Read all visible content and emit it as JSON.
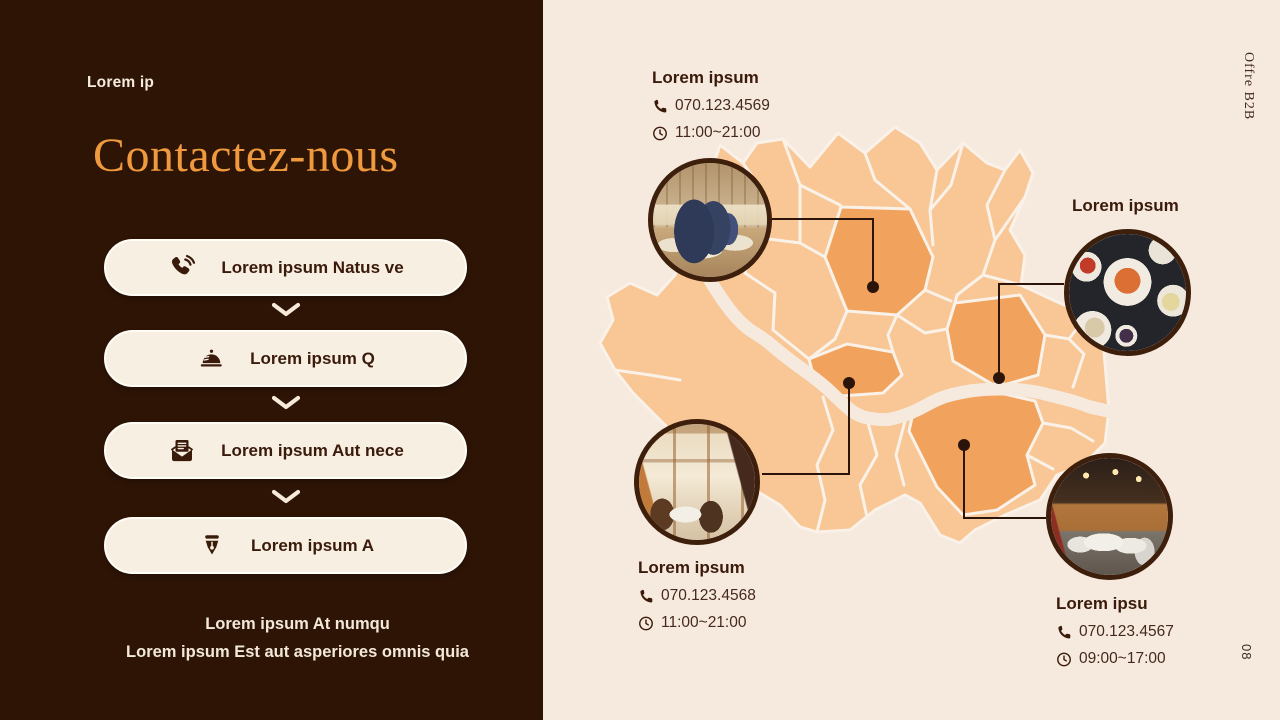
{
  "slide": {
    "eyebrow": "Lorem ip",
    "title": "Contactez-nous",
    "menu": [
      {
        "icon": "phone-ring-icon",
        "label": "Lorem ipsum Natus ve"
      },
      {
        "icon": "cloche-icon",
        "label": "Lorem ipsum Q"
      },
      {
        "icon": "mail-icon",
        "label": "Lorem ipsum Aut nece"
      },
      {
        "icon": "pen-nib-icon",
        "label": "Lorem ipsum A"
      }
    ],
    "footer_line1": "Lorem ipsum At numqu",
    "footer_line2": "Lorem ipsum Est aut asperiores omnis quia",
    "side_label": "Offre B2B",
    "page_number": "08"
  },
  "locations": [
    {
      "name": "Lorem ipsum",
      "phone": "070.123.4569",
      "hours": "11:00~21:00"
    },
    {
      "name": "Lorem ipsum"
    },
    {
      "name": "Lorem ipsum",
      "phone": "070.123.4568",
      "hours": "11:00~21:00"
    },
    {
      "name": "Lorem ipsu",
      "phone": "070.123.4567",
      "hours": "09:00~17:00"
    }
  ],
  "icons": {
    "contact_phone": "phone-handset-icon",
    "contact_hours": "clock-icon",
    "between_menu": "chevron-down-icon"
  },
  "colors": {
    "left_bg": "#2e1405",
    "right_bg": "#f6eadf",
    "accent": "#ef9a3e",
    "button_fill": "#f8efe3",
    "button_border": "#fffdf6",
    "dark_text": "#3a1a0a",
    "cream_text": "#f5ebdf",
    "map_light": "#f8c795",
    "map_highlight": "#f1a25c",
    "marker": "#2b140a",
    "circle_border": "#3d1f0c",
    "boundary": "#faf1e8"
  }
}
